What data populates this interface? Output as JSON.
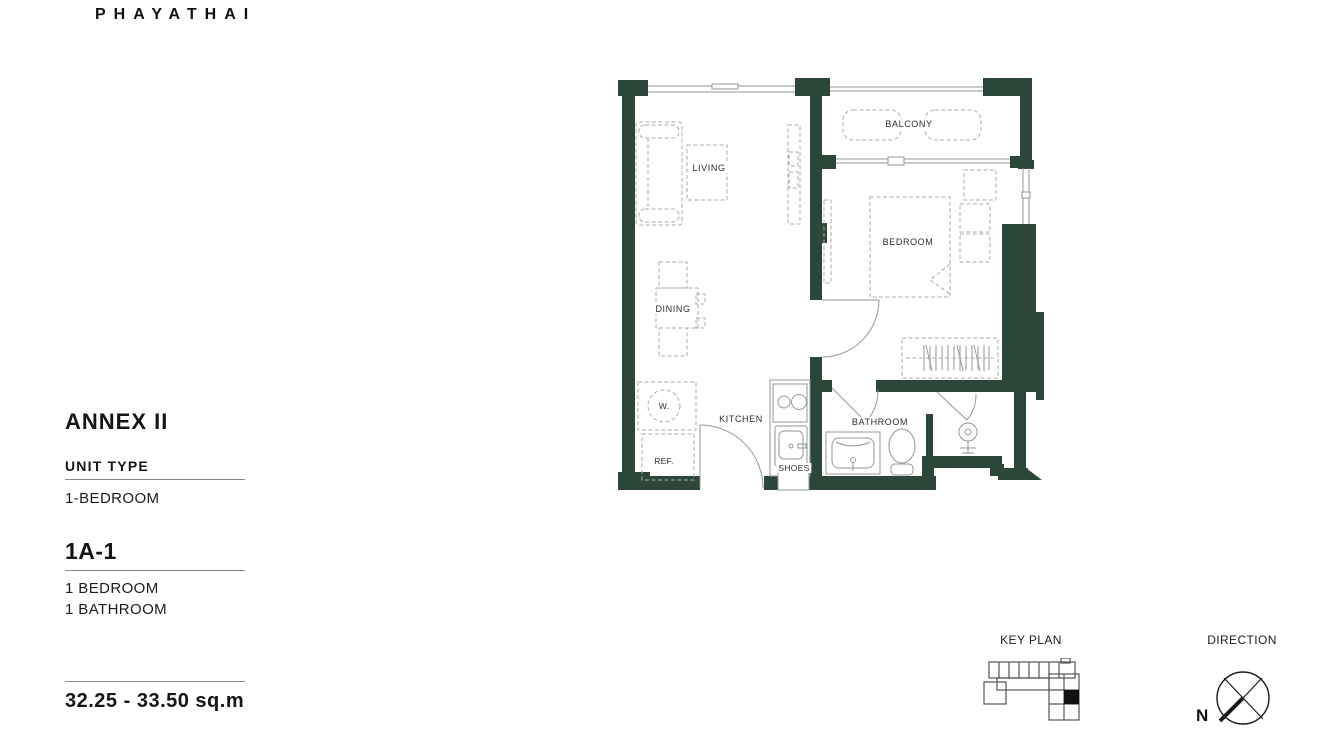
{
  "brand": {
    "logo_text": "PHAYATHAI"
  },
  "info": {
    "project_title": "ANNEX II",
    "unit_type_label": "UNIT TYPE",
    "unit_type_value": "1-BEDROOM",
    "unit_code": "1A-1",
    "features": [
      "1 BEDROOM",
      "1 BATHROOM"
    ],
    "area_range": "32.25 - 33.50 sq.m"
  },
  "plan": {
    "labels": {
      "living": "LIVING",
      "balcony": "BALCONY",
      "bedroom": "BEDROOM",
      "dining": "DINING",
      "kitchen": "KITCHEN",
      "bathroom": "BATHROOM",
      "washer": "W.",
      "refrigerator": "REF.",
      "shoes": "SHOES"
    }
  },
  "legend": {
    "key_plan": "KEY PLAN",
    "direction": "DIRECTION",
    "north": "N"
  },
  "colors": {
    "wall_green": "#2c4639",
    "plan_line": "#8f9a94",
    "furniture_line": "#a6ada8",
    "text_dark": "#1d1d1b"
  }
}
